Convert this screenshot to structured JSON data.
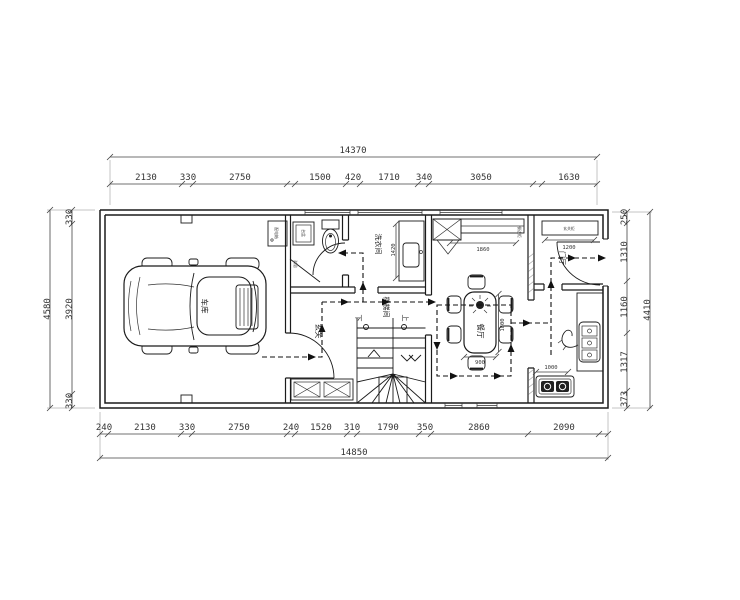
{
  "drawing": {
    "rooms": {
      "garage": "车库",
      "laundry": "洗衣间",
      "entry": "玄关",
      "stair_hall": "楼梯间",
      "dining": "餐厅",
      "foyer": "门厅"
    },
    "fixtures": {
      "bathroom_basin": "台盆",
      "bathroom_shower": "淋浴",
      "electrical_box": "配电箱",
      "sideboard": "餐边柜",
      "foyer_cabinet": "玄关柜"
    },
    "stair": {
      "up": "上",
      "down": "下"
    },
    "inner_dims": {
      "laundry_counter": "1420",
      "sideboard": "1860",
      "table_length": "1800",
      "table_width": "900",
      "foyer_cabinet": "1200",
      "kitchen_counter": "1000"
    }
  },
  "dimensions": {
    "top_total": "14370",
    "top_segments": [
      "2130",
      "330",
      "2750",
      "1500",
      "420",
      "1710",
      "340",
      "3050",
      "1630"
    ],
    "bottom_segments": [
      "240",
      "2130",
      "330",
      "2750",
      "240",
      "1520",
      "310",
      "1790",
      "350",
      "2860",
      "2090"
    ],
    "bottom_total": "14850",
    "left_total": "4580",
    "left_segments": [
      "330",
      "3920",
      "330"
    ],
    "right_total": "4410",
    "right_segments": [
      "250",
      "1310",
      "1160",
      "1317",
      "373"
    ]
  }
}
